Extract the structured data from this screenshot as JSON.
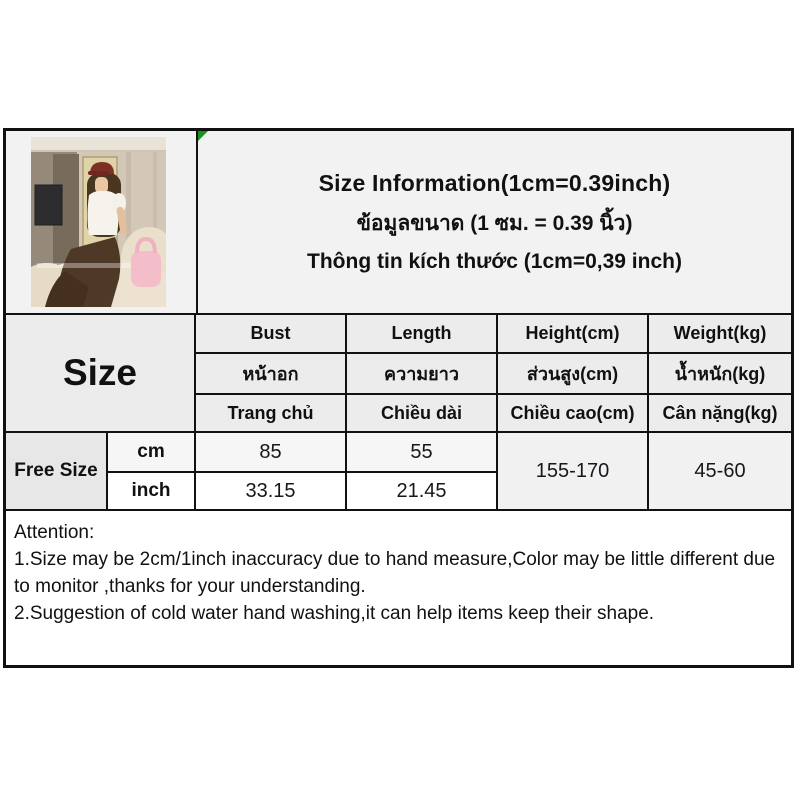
{
  "colors": {
    "page_bg": "#ffffff",
    "section_bg": "#f2f2f2",
    "header_cell_bg": "#ececec",
    "gray_row_bg": "#f6f6f6",
    "merged_cell_bg": "#f1f1f1",
    "white_cell_bg": "#ffffff",
    "border": "#111111",
    "text": "#111114",
    "corner_marker_green": "#18941c"
  },
  "title": {
    "en": "Size Information(1cm=0.39inch)",
    "th": "ข้อมูลขนาด (1 ซม. = 0.39 นิ้ว)",
    "vi": "Thông tin kích thước (1cm=0,39 inch)"
  },
  "table": {
    "corner_label": "Size",
    "columns_en": [
      "Bust",
      "Length",
      "Height(cm)",
      "Weight(kg)"
    ],
    "columns_th": [
      "หน้าอก",
      "ความยาว",
      "ส่วนสูง(cm)",
      "น้ำหนัก(kg)"
    ],
    "columns_vi": [
      "Trang chủ",
      "Chiều dài",
      "Chiều cao(cm)",
      "Cân nặng(kg)"
    ],
    "size_label": "Free Size",
    "unit_rows": [
      {
        "unit": "cm",
        "bust": "85",
        "length": "55"
      },
      {
        "unit": "inch",
        "bust": "33.15",
        "length": "21.45"
      }
    ],
    "height_range": "155-170",
    "weight_range": "45-60"
  },
  "attention": {
    "heading": "Attention:",
    "note1": "1.Size may be 2cm/1inch inaccuracy due to hand measure,Color may be little different due to monitor ,thanks for your understanding.",
    "note2": "2.Suggestion of cold water hand washing,it can help items keep their shape."
  }
}
